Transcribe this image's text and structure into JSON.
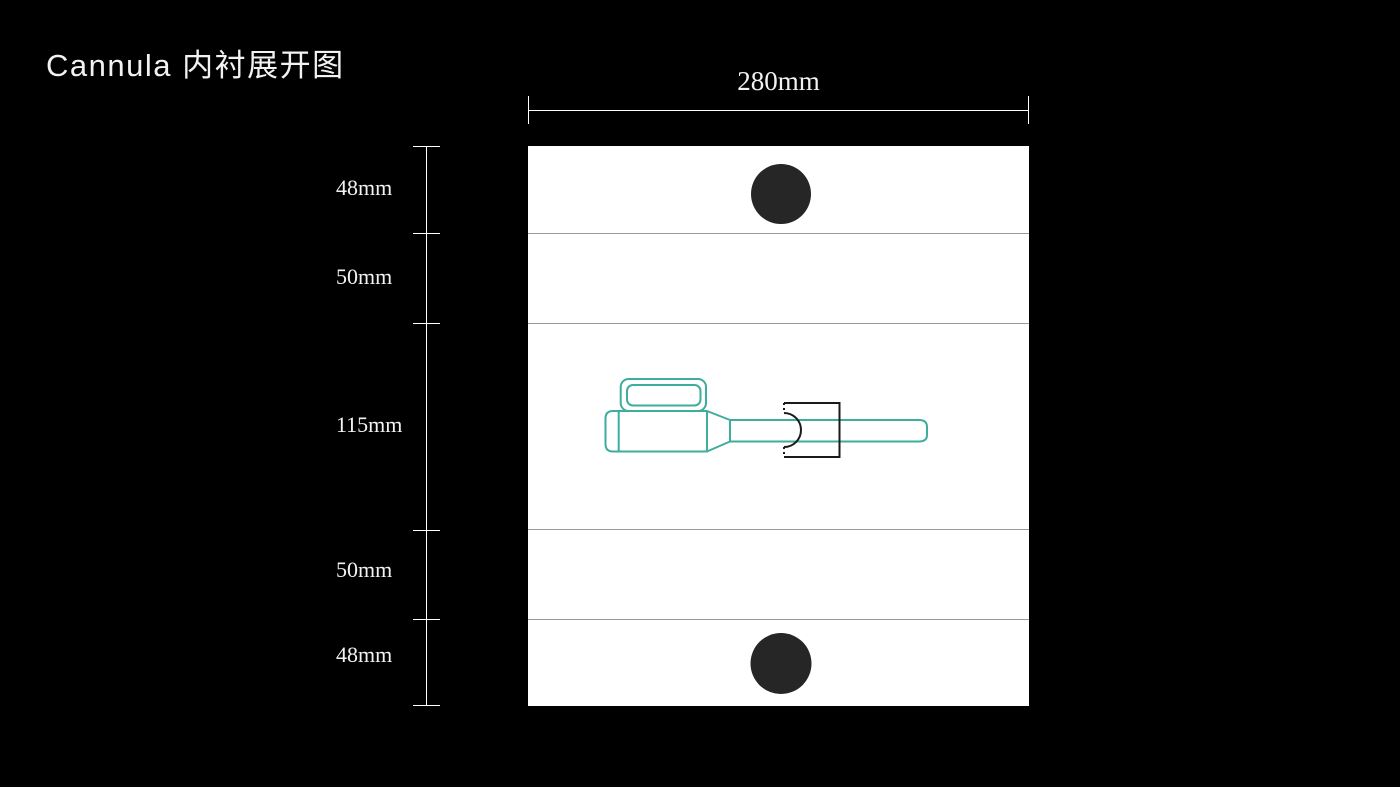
{
  "title": "Cannula 内衬展开图",
  "colors": {
    "background": "#000000",
    "panel": "#ffffff",
    "fold_line": "#9b9b9b",
    "dimension_line": "#ffffff",
    "punch_hole_fill": "#262626",
    "cannula_outline": "#3dae9e",
    "clamp_outline": "#1a1a1a"
  },
  "dimensions": {
    "width": {
      "label": "280mm"
    },
    "side": {
      "items": [
        {
          "label": "48mm"
        },
        {
          "label": "50mm"
        },
        {
          "label": "115mm"
        },
        {
          "label": "50mm"
        },
        {
          "label": "48mm"
        }
      ]
    }
  },
  "panel": {
    "sections_mm": [
      48,
      50,
      115,
      50,
      48
    ],
    "width_mm": 280
  }
}
